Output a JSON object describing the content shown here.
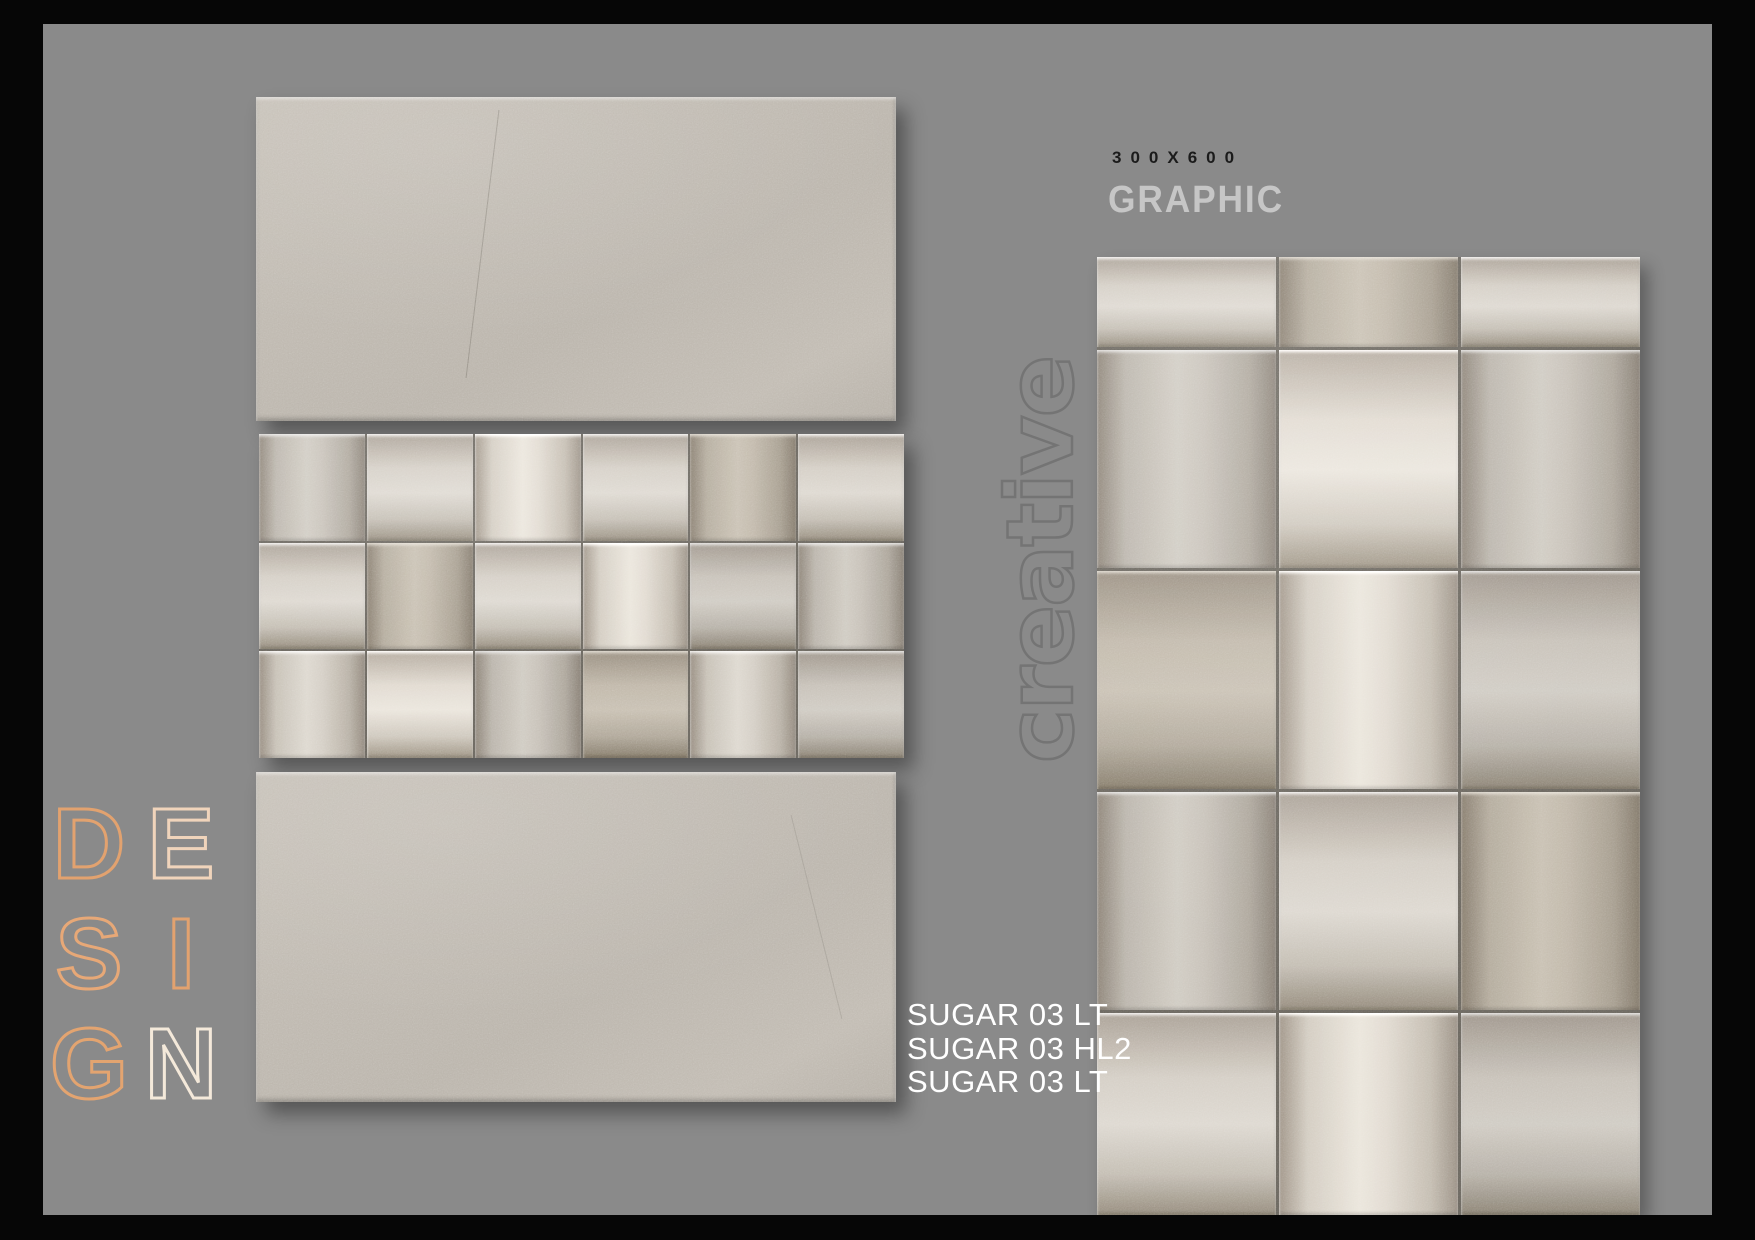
{
  "colors": {
    "frame": "#060606",
    "background": "#8a8a8a",
    "tile_base": "#beb8af",
    "seam": "#6b6760",
    "accent_orange": "#e2a26f",
    "size_text": "#1b1b1b",
    "type_text": "#c6c6c6",
    "watermark_stroke": "#747474",
    "label_white": "#ffffff"
  },
  "header": {
    "size_label": "300X600",
    "type_label": "GRAPHIC"
  },
  "watermark": {
    "text": "creative"
  },
  "design_word": {
    "text": "DESIGN",
    "letters": [
      {
        "char": "D",
        "color": "#e2a26f"
      },
      {
        "char": "E",
        "color": "#f0d4bb"
      },
      {
        "char": "S",
        "color": "#e7a877"
      },
      {
        "char": "I",
        "color": "#e2a26f"
      },
      {
        "char": "G",
        "color": "#e3a470"
      },
      {
        "char": "N",
        "color": "#f4e9da"
      }
    ]
  },
  "product_labels": [
    "SUGAR 03 LT",
    "SUGAR 03 HL2",
    "SUGAR 03 LT"
  ],
  "tiles": {
    "top_plain": {
      "kind": "plain"
    },
    "middle_weave": {
      "kind": "weave",
      "rows": 3,
      "cols": 6,
      "cells": [
        [
          "v m",
          "h l",
          "v b",
          "h l",
          "v d",
          "h l"
        ],
        [
          "h l",
          "v d",
          "h l",
          "v b",
          "h m",
          "v m"
        ],
        [
          "v l",
          "h b",
          "v m",
          "h d",
          "v l",
          "h m"
        ]
      ]
    },
    "bottom_plain": {
      "kind": "plain"
    },
    "large_panel": {
      "kind": "weave",
      "rows": 5,
      "cols": 3,
      "cells": [
        [
          "h l",
          "v d",
          "h l"
        ],
        [
          "v m",
          "h b",
          "v m"
        ],
        [
          "h d",
          "v b",
          "h m"
        ],
        [
          "v m",
          "h l",
          "v d"
        ],
        [
          "h l",
          "v b",
          "h m"
        ]
      ]
    }
  }
}
